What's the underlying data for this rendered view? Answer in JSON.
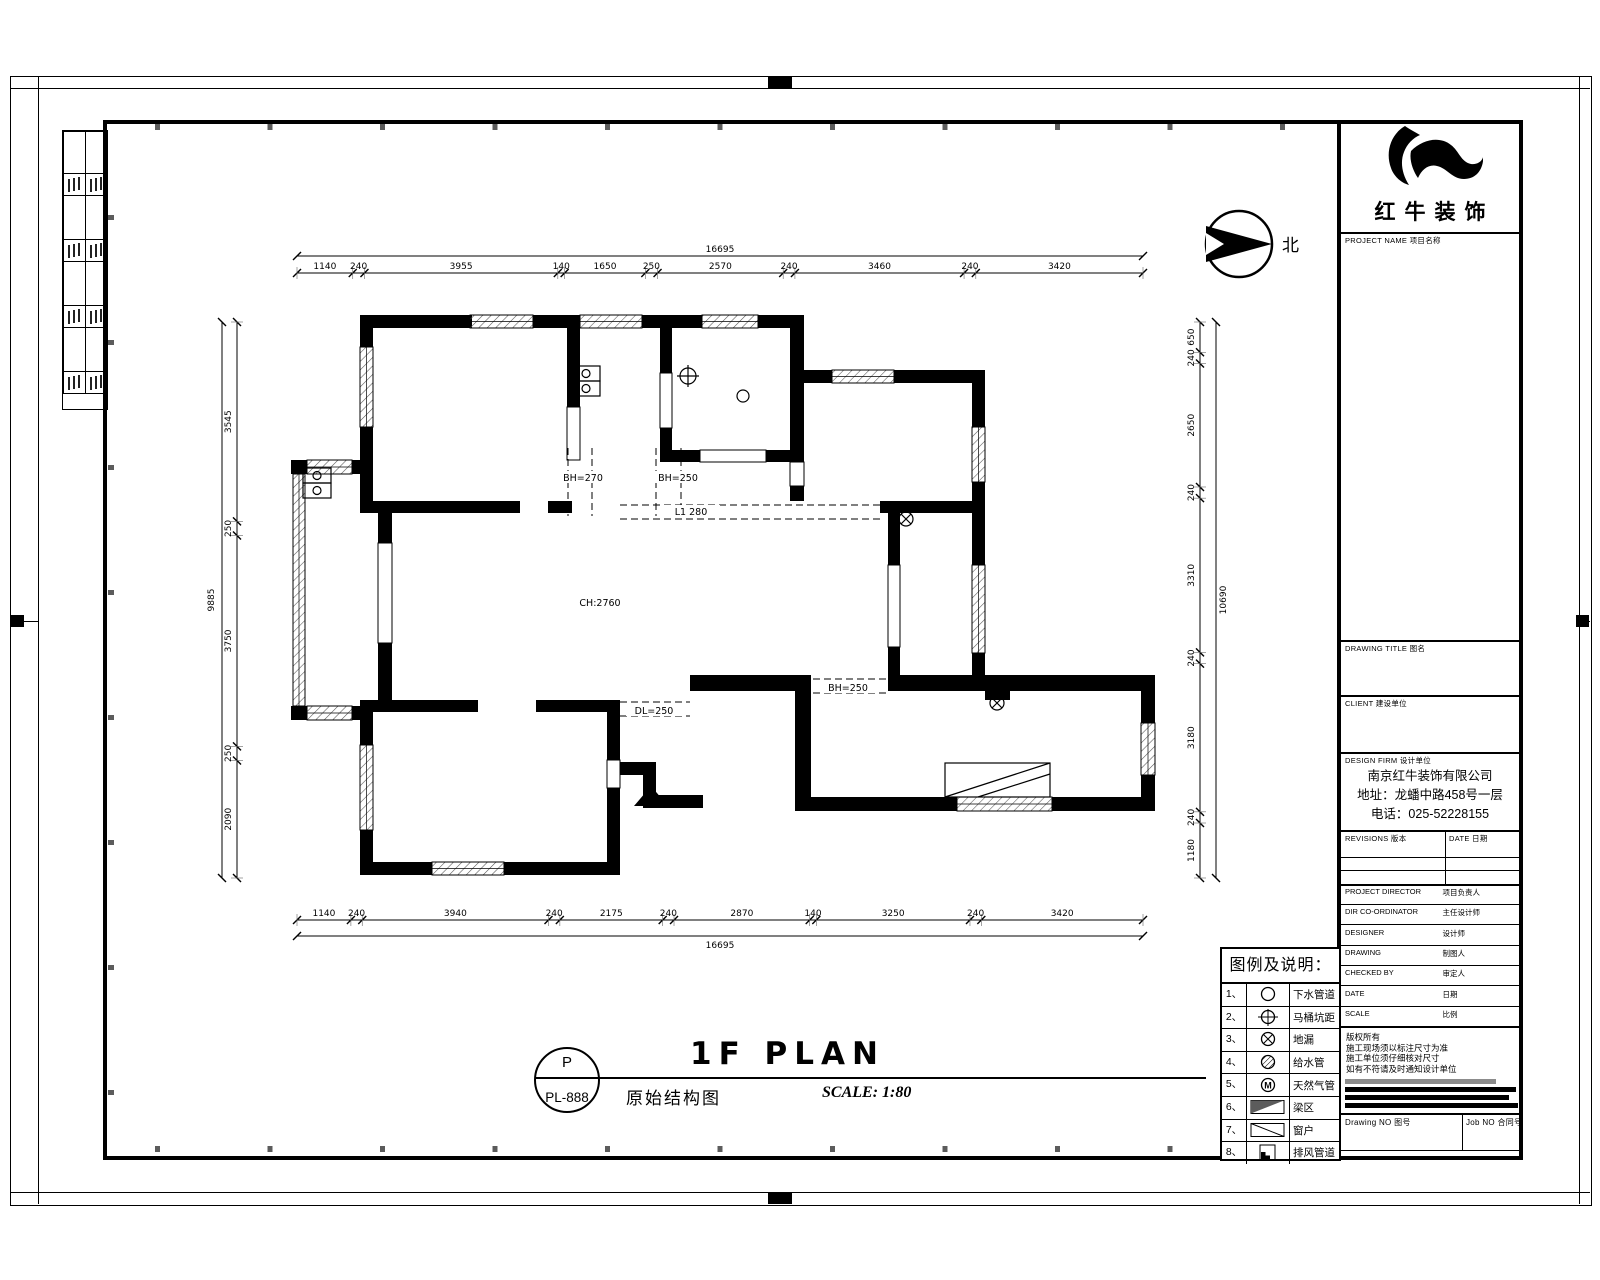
{
  "branding": {
    "company": "红牛装饰"
  },
  "north_label": "北",
  "title_bar": {
    "bubble_top": "P",
    "bubble_bottom": "PL-888",
    "title": "1F PLAN",
    "subtitle": "原始结构图",
    "scale": "SCALE: 1:80"
  },
  "title_block": {
    "project_label": "PROJECT NAME 项目名称",
    "drawing_title_label": "DRAWING TITLE 图名",
    "client_label": "CLIENT 建设单位",
    "design_firm_label": "DESIGN FIRM 设计单位",
    "firm_name": "南京红牛装饰有限公司",
    "firm_address": "地址：龙蟠中路458号一层",
    "firm_phone": "电话：025-52228155",
    "revisions_label": "REVISIONS 版本",
    "revision_date_label": "DATE 日期",
    "personnel_rows": [
      {
        "en": "PROJECT DIRECTOR",
        "cn": "项目负责人"
      },
      {
        "en": "DIR CO-ORDINATOR",
        "cn": "主任设计师"
      },
      {
        "en": "DESIGNER",
        "cn": "设计师"
      },
      {
        "en": "DRAWING",
        "cn": "制图人"
      },
      {
        "en": "CHECKED BY",
        "cn": "审定人"
      },
      {
        "en": "DATE",
        "cn": "日期"
      },
      {
        "en": "SCALE",
        "cn": "比例"
      }
    ],
    "notes_cn": [
      "版权所有",
      "施工现场须以标注尺寸为准",
      "施工单位须仔细核对尺寸",
      "如有不符请及时通知设计单位"
    ],
    "drawing_no_label": "Drawing NO 图号",
    "job_no_label": "Job NO 合同号"
  },
  "legend": {
    "title": "图例及说明：",
    "rows": [
      {
        "no": "1、",
        "symbol": "circle",
        "label": "下水管道"
      },
      {
        "no": "2、",
        "symbol": "circle-cross",
        "label": "马桶坑距"
      },
      {
        "no": "3、",
        "symbol": "circle-x",
        "label": "地漏"
      },
      {
        "no": "4、",
        "symbol": "circle-hatch",
        "label": "给水管"
      },
      {
        "no": "5、",
        "symbol": "circle-m",
        "label": "天然气管"
      },
      {
        "no": "6、",
        "symbol": "beam",
        "label": "梁区"
      },
      {
        "no": "7、",
        "symbol": "window",
        "label": "窗户"
      },
      {
        "no": "8、",
        "symbol": "duct",
        "label": "排风管道"
      }
    ]
  },
  "plan": {
    "ceiling_label": "CH:2760",
    "beams": {
      "bh270": "BH=270",
      "bh250a": "BH=250",
      "l280": "L1 280",
      "dl250": "DL=250",
      "bh250b": "BH=250"
    },
    "dims": {
      "top": {
        "values": [
          1140,
          240,
          3955,
          140,
          1650,
          250,
          2570,
          240,
          3460,
          240,
          3420
        ],
        "total": "16695"
      },
      "bottom": {
        "values": [
          1140,
          240,
          3940,
          240,
          2175,
          240,
          2870,
          140,
          3250,
          240,
          3420
        ],
        "total": "16695"
      },
      "left": {
        "values": [
          3545,
          250,
          3750,
          250,
          2090
        ],
        "total": "9885"
      },
      "right": {
        "values": [
          650,
          240,
          2650,
          240,
          3310,
          240,
          3180,
          240,
          1180
        ],
        "total": "10690"
      }
    }
  }
}
